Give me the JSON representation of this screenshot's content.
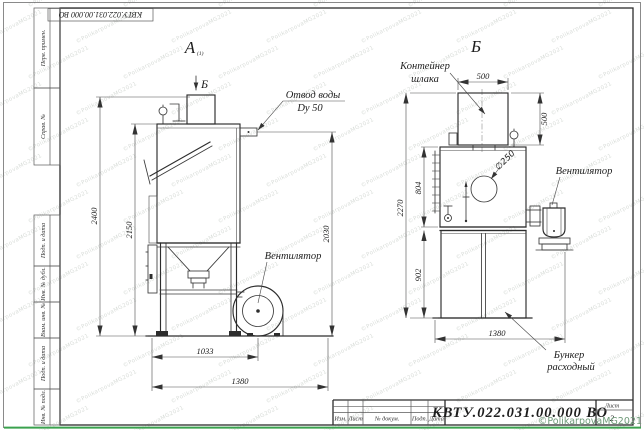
{
  "sheet": {
    "top_stamp": "КВТУ.022.031.00.000  ВО",
    "margin_top": [
      "Перв. примен.",
      "Справ. №"
    ],
    "margin_bottom": [
      "Подп. и дата",
      "Инв. № дубл.",
      "Взам. инв. №",
      "Подп. и дата",
      "Инв. № подл."
    ]
  },
  "front_view": {
    "label": "А",
    "label_note": "(1)",
    "section_label": "Б",
    "ann": {
      "water1": "Отвод воды",
      "water2": "Dy 50",
      "fan": "Вентилятор"
    },
    "dim": {
      "h_total": "2400",
      "h_body": "2150",
      "h_outlet": "2030",
      "w_fan": "1033",
      "w_total": "1380"
    }
  },
  "side_view": {
    "label": "Б",
    "ann": {
      "cont1": "Контейнер",
      "cont2": "шлака",
      "dia": "∅250",
      "fan": "Вентилятор",
      "bunker1": "Бункер",
      "bunker2": "расходный"
    },
    "dim": {
      "cont_w": "500",
      "cont_h": "500",
      "body_h": "804",
      "cab_h": "902",
      "h_total": "2270",
      "w_total": "1380"
    }
  },
  "title_block": {
    "headers": [
      "Изм.",
      "Лист",
      "№ докум.",
      "Подп.",
      "Дата"
    ],
    "doc_number": "КВТУ.022.031.00.000  ВО",
    "sheet_label": "Лист",
    "sheet_number": "2"
  },
  "watermark": {
    "text": "©PolikarpovaMG2021",
    "tiled": "©PolikarpovaMG2021"
  }
}
